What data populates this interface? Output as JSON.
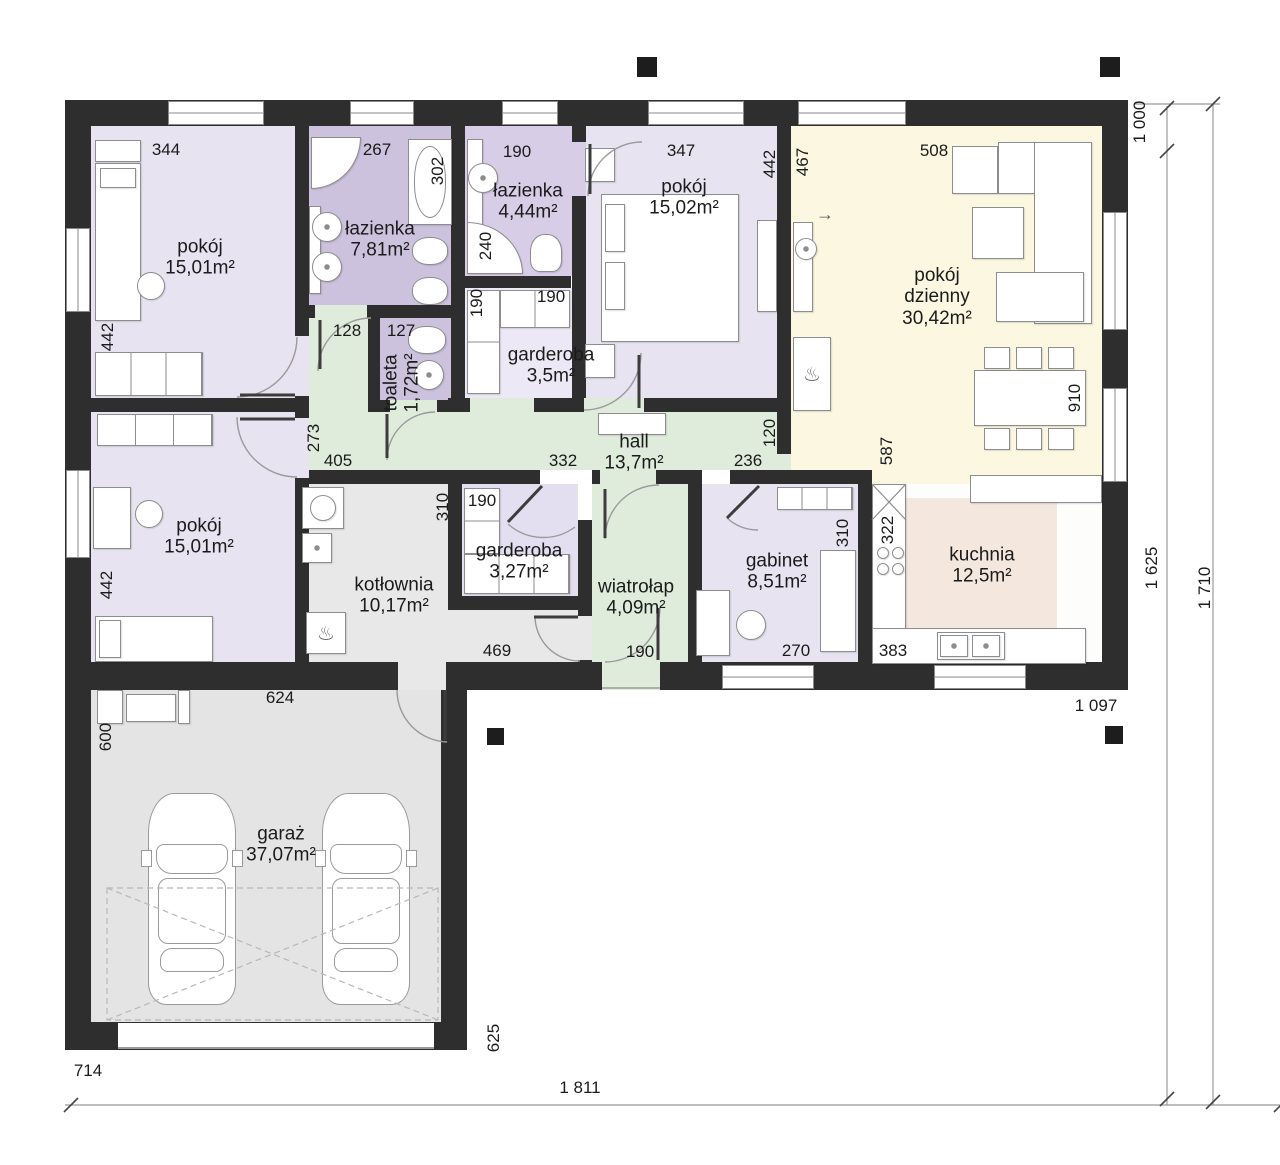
{
  "rooms": {
    "pokojTL": {
      "label": "pokój",
      "area": "15,01m²"
    },
    "lazienkaDuza": {
      "label": "łazienka",
      "area": "7,81m²"
    },
    "toaleta": {
      "label": "toaleta",
      "area": "1,72m²"
    },
    "lazienkaMala": {
      "label": "łazienka",
      "area": "4,44m²"
    },
    "garderobaGorna": {
      "label": "garderoba",
      "area": "3,5m²"
    },
    "pokojSypialnia": {
      "label": "pokój",
      "area": "15,02m²"
    },
    "pokojDzienny": {
      "label": "pokój dzienny",
      "area": "30,42m²"
    },
    "hall": {
      "label": "hall",
      "area": "13,7m²"
    },
    "pokojML": {
      "label": "pokój",
      "area": "15,01m²"
    },
    "kotlownia": {
      "label": "kotłownia",
      "area": "10,17m²"
    },
    "garderobaDolna": {
      "label": "garderoba",
      "area": "3,27m²"
    },
    "wiatrolap": {
      "label": "wiatrołap",
      "area": "4,09m²"
    },
    "gabinet": {
      "label": "gabinet",
      "area": "8,51m²"
    },
    "kuchnia": {
      "label": "kuchnia",
      "area": "12,5m²"
    },
    "garaz": {
      "label": "garaż",
      "area": "37,07m²"
    }
  },
  "dims": {
    "d344": "344",
    "d267": "267",
    "d302": "302",
    "d190_lazienka": "190",
    "d240": "240",
    "d347": "347",
    "d442_sypialnia": "442",
    "d467": "467",
    "d508": "508",
    "d1000": "1 000",
    "d442_pokoj_gorny": "442",
    "d128": "128",
    "d127": "127",
    "d190_garderoba_lewa": "190",
    "d190_garderoba_prawa": "190",
    "d273": "273",
    "d405": "405",
    "d332": "332",
    "d120": "120",
    "d236": "236",
    "d587": "587",
    "d910": "910",
    "d310_kotlownia": "310",
    "d190_garderoba_dolna": "190",
    "d469": "469",
    "d190_wiatrolap": "190",
    "d270": "270",
    "d310_gabinet": "310",
    "d383": "383",
    "d322": "322",
    "d442_pokoj_dolny": "442",
    "d624": "624",
    "d600": "600",
    "d625": "625",
    "d714": "714",
    "d1811": "1 811",
    "d1097": "1 097",
    "d1625": "1 625",
    "d1710": "1 710"
  },
  "symbols": {
    "arrow_right": "→",
    "heat": "♨"
  },
  "colors": {
    "wall": "#2e2e2e",
    "room_lavender": "#e7e3f1",
    "bathroom_purple": "#cdc2de",
    "bathroom_light": "#d8cde6",
    "hall_green": "#dfecdc",
    "living_cream": "#fbf7e1",
    "kitchen_pink": "#f3e7de",
    "utility_gray": "#e8e8e8",
    "furniture_line": "#8d8d8d"
  }
}
